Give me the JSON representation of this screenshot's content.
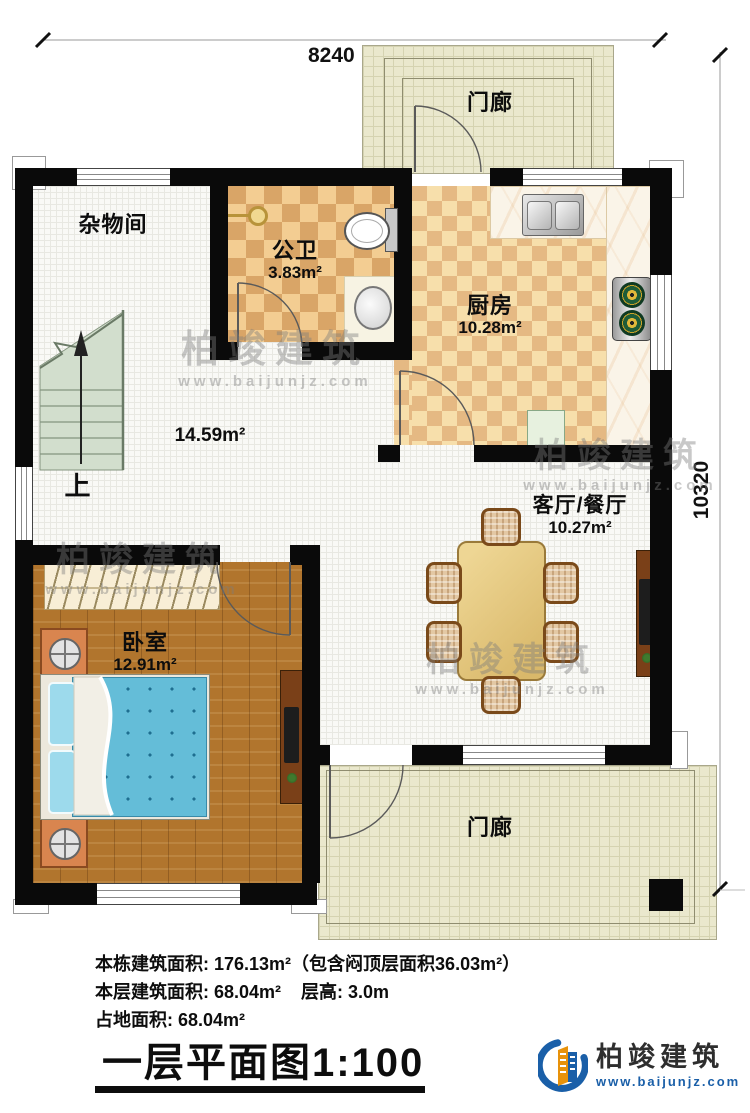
{
  "dimensions": {
    "width": "8240",
    "height": "10320"
  },
  "rooms": {
    "porch_top": {
      "name": "门廊"
    },
    "porch_bottom": {
      "name": "门廊"
    },
    "storage": {
      "name": "杂物间"
    },
    "bathroom": {
      "name": "公卫",
      "area": "3.83m²"
    },
    "kitchen": {
      "name": "厨房",
      "area": "10.28m²"
    },
    "hall": {
      "area": "14.59m²",
      "stairs_up": "上"
    },
    "living": {
      "name": "客厅/餐厅",
      "area": "10.27m²"
    },
    "bedroom": {
      "name": "卧室",
      "area": "12.91m²"
    }
  },
  "info": {
    "line1": "本栋建筑面积: 176.13m²（包含闷顶层面积36.03m²）",
    "line2": "本层建筑面积: 68.04m²    层高: 3.0m",
    "line3": "占地面积: 68.04m²"
  },
  "title": "一层平面图1:100",
  "watermark": {
    "name": "柏竣建筑",
    "url": "www.baijunjz.com"
  },
  "brand": {
    "name": "柏竣建筑",
    "url": "www.baijunjz.com"
  }
}
